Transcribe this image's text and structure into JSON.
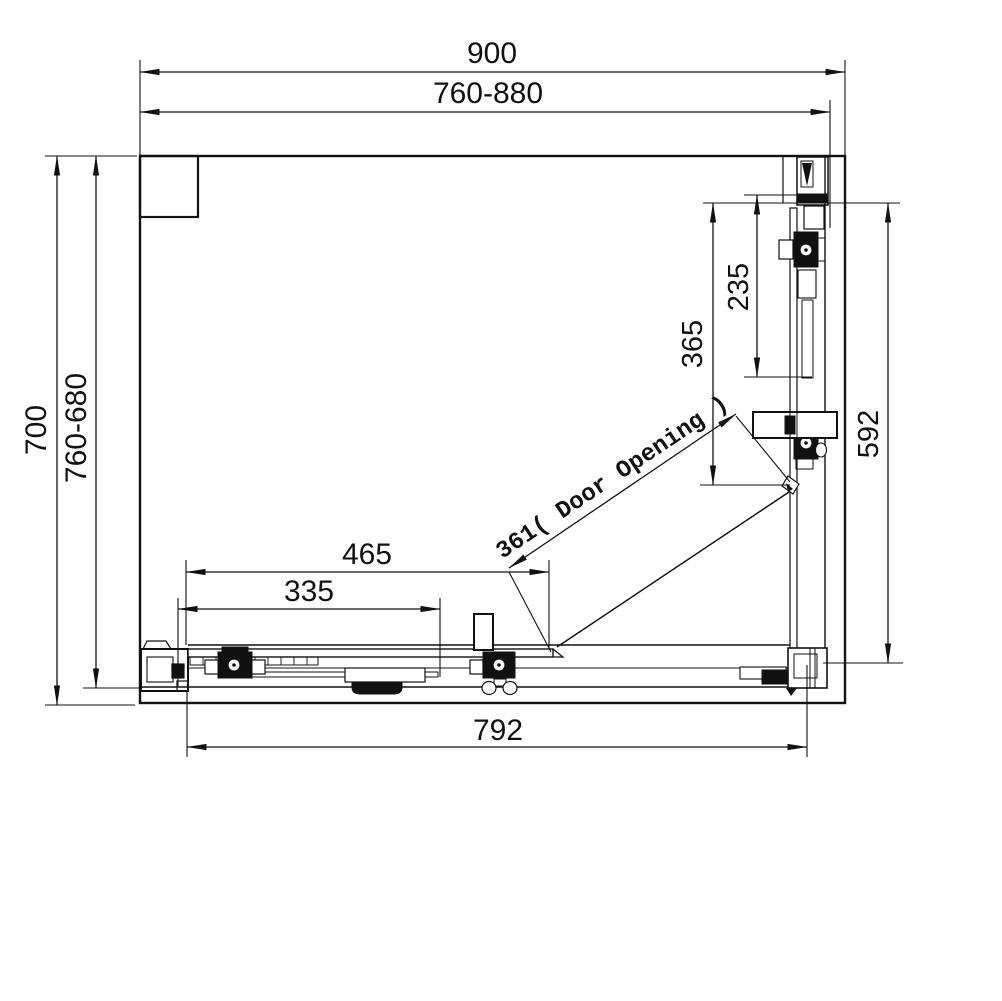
{
  "drawing": {
    "type": "technical-dimension-drawing",
    "subject": "sliding-door shower enclosure, plan view",
    "background": "#ffffff",
    "line_color": "#111111",
    "dimensions": {
      "top_outer": "900",
      "top_adjustable": "760-880",
      "left_outer": "700",
      "left_adjustable": "760-680",
      "right_fixed_panel": "235",
      "right_mid_span": "365",
      "right_overall": "592",
      "door_opening": "361( Door Opening )",
      "bottom_door_panel": "465",
      "bottom_inner_panel": "335",
      "bottom_overall": "792"
    }
  }
}
